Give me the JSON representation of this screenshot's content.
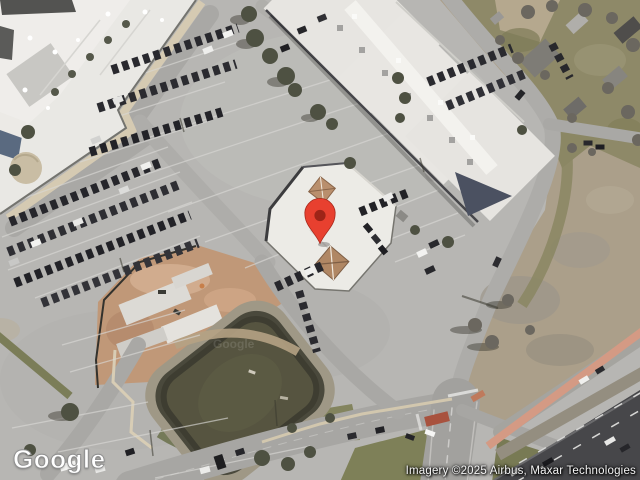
{
  "map": {
    "view_type": "satellite",
    "provider_logo": "Google",
    "tile_watermark": "Google",
    "attribution": "Imagery ©2025 Airbus, Maxar Technologies",
    "marker": {
      "label": "location-pin",
      "color": "#E8402F",
      "inner_dot_color": "#9E2417",
      "position_px": {
        "x": 320,
        "y": 243
      }
    },
    "palette": {
      "pavement": "#b7b6b3",
      "roof_white": "#e9e8e4",
      "pond_water": "#565440",
      "construction_dirt": "#c09878",
      "grass": "#8e8968",
      "highway": "#47474a",
      "sidewalk_tan": "#d5cab2",
      "salmon_path": "#d49a84"
    }
  }
}
